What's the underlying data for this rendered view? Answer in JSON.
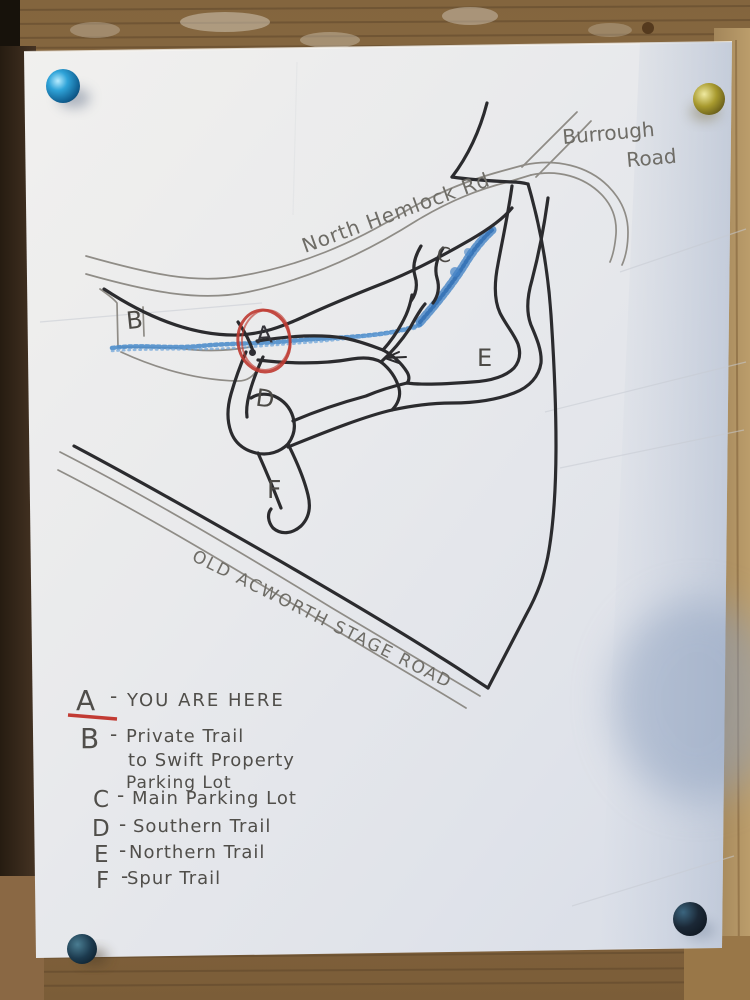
{
  "photo": {
    "surface": "hand-drawn trail map pinned to wooden board",
    "pins": [
      {
        "position": "top-left",
        "color": "#1f8fc4"
      },
      {
        "position": "top-right",
        "color": "#a89a2e"
      },
      {
        "position": "bottom-left",
        "color": "#1c3a4e"
      },
      {
        "position": "bottom-right",
        "color": "#16202c"
      }
    ]
  },
  "map": {
    "roads": {
      "north_hemlock": "North Hemlock Rd",
      "burrough_line1": "Burrough",
      "burrough_line2": "Road",
      "old_acworth_stage": "OLD ACWORTH STAGE ROAD"
    },
    "markers": {
      "a": "A",
      "b": "B",
      "c": "C",
      "d": "D",
      "e": "E",
      "f": "F"
    },
    "colors": {
      "stream": "#4a86c8",
      "you_are_here_circle": "#bf3a31",
      "trail_ink": "#2b2b2e",
      "pencil": "#85827c",
      "paper": "#e7e8ec"
    }
  },
  "legend": {
    "sep": "-",
    "items": [
      {
        "key": "A",
        "label": "YOU ARE HERE"
      },
      {
        "key": "B",
        "label_line1": "Private Trail",
        "label_line2": "to Swift Property",
        "label_line3": "Parking Lot"
      },
      {
        "key": "C",
        "label": "Main Parking Lot"
      },
      {
        "key": "D",
        "label": "Southern Trail"
      },
      {
        "key": "E",
        "label": "Northern Trail"
      },
      {
        "key": "F",
        "label": "Spur Trail"
      }
    ]
  }
}
